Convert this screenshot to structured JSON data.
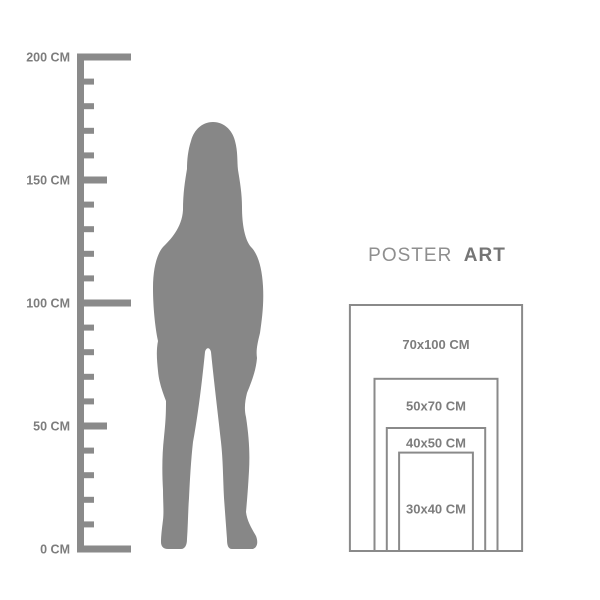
{
  "brand": {
    "word_regular": "POSTER",
    "word_bold": "ART"
  },
  "ruler": {
    "unit": "CM",
    "min_cm": 0,
    "max_cm": 200,
    "tick_step_cm": 10,
    "labeled_marks": [
      {
        "cm": 200,
        "label": "200 CM"
      },
      {
        "cm": 150,
        "label": "150 CM"
      },
      {
        "cm": 100,
        "label": "100 CM"
      },
      {
        "cm": 50,
        "label": "50 CM"
      },
      {
        "cm": 0,
        "label": "0 CM"
      }
    ]
  },
  "figure": {
    "icon": "woman-silhouette"
  },
  "poster_sizes": [
    {
      "label": "70x100 CM",
      "width_cm": 70,
      "height_cm": 100
    },
    {
      "label": "50x70 CM",
      "width_cm": 50,
      "height_cm": 70
    },
    {
      "label": "40x50 CM",
      "width_cm": 40,
      "height_cm": 50
    },
    {
      "label": "30x40 CM",
      "width_cm": 30,
      "height_cm": 40
    }
  ],
  "colors": {
    "background": "#ffffff",
    "silhouette": "#878787",
    "ruler": "#8a8a8a",
    "frame_border": "#8a8a8a",
    "label_text": "#7d7d7d",
    "brand_regular": "#8f8f8f",
    "brand_bold": "#757575"
  }
}
